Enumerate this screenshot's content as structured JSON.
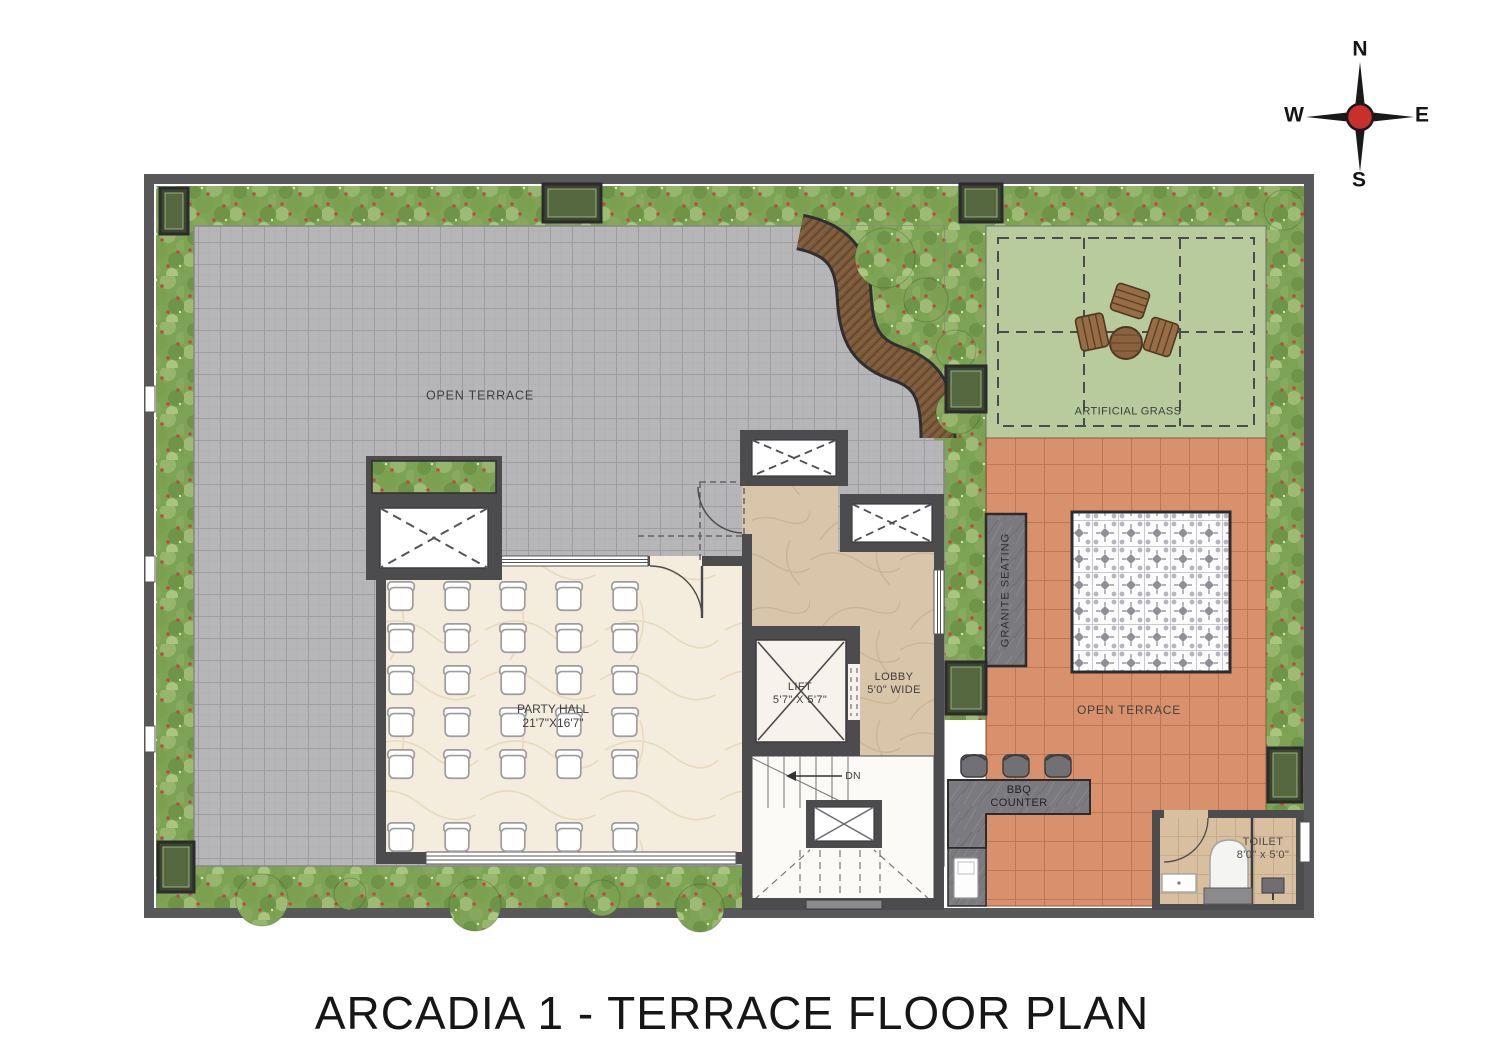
{
  "title": "ARCADIA 1 - TERRACE FLOOR PLAN",
  "compass": {
    "north": "N",
    "south": "S",
    "east": "E",
    "west": "W"
  },
  "labels": {
    "open_terrace_left": "OPEN TERRACE",
    "party_hall": {
      "name": "PARTY HALL",
      "dim": "21'7\"X16'7\""
    },
    "lift": {
      "name": "LIFT",
      "dim": "5'7\" X 5'7\""
    },
    "lobby": {
      "name": "LOBBY",
      "dim": "5'0\" WIDE"
    },
    "stairs": {
      "direction": "DN"
    },
    "artificial_grass": "ARTIFICIAL GRASS",
    "granite_seating": "GRANITE  SEATING",
    "open_terrace_right": "OPEN TERRACE",
    "bbq_counter": {
      "line1": "BBQ",
      "line2": "COUNTER"
    },
    "toilet": {
      "name": "TOILET",
      "dim": "8'0\" x 5'0\""
    }
  },
  "colors": {
    "wall": "#4c4c4e",
    "gray_tile": "#b6b6b8",
    "orange_tile": "#d78f6a",
    "artificial_grass": "#b7cb9c",
    "planting": "#7da355",
    "party_hall_floor": "#f4ecdc",
    "lobby_floor": "#d9c5a9",
    "wood_deck": "#7b5a3b",
    "granite": "#7b7b7f",
    "compass_center": "#c9302c"
  }
}
